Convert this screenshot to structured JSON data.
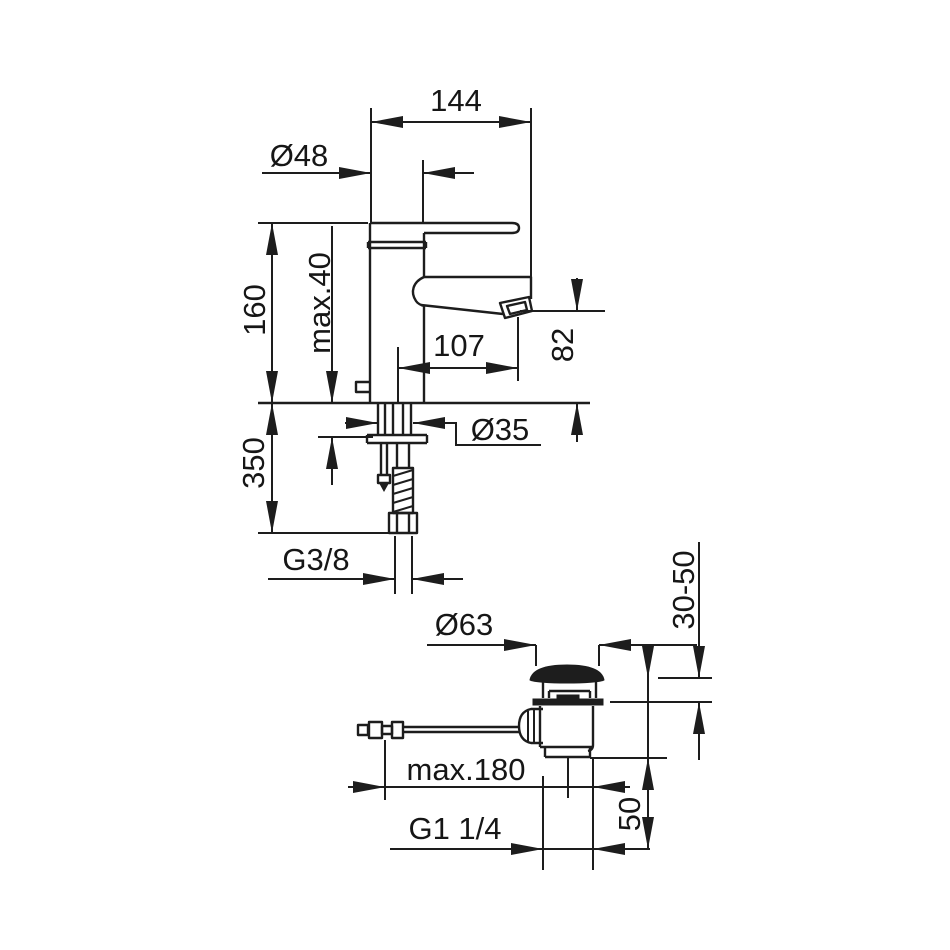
{
  "drawing": {
    "background": "#ffffff",
    "line_color": "#1d1d1d",
    "labels": {
      "d144": "144",
      "d48": "Ø48",
      "d160": "160",
      "dmax40": "max.40",
      "d107": "107",
      "d82": "82",
      "d350": "350",
      "d35": "Ø35",
      "dg38": "G3/8",
      "d63": "Ø63",
      "d3050": "30-50",
      "dmax180": "max.180",
      "dg114": "G1 1/4",
      "d50": "50"
    }
  }
}
